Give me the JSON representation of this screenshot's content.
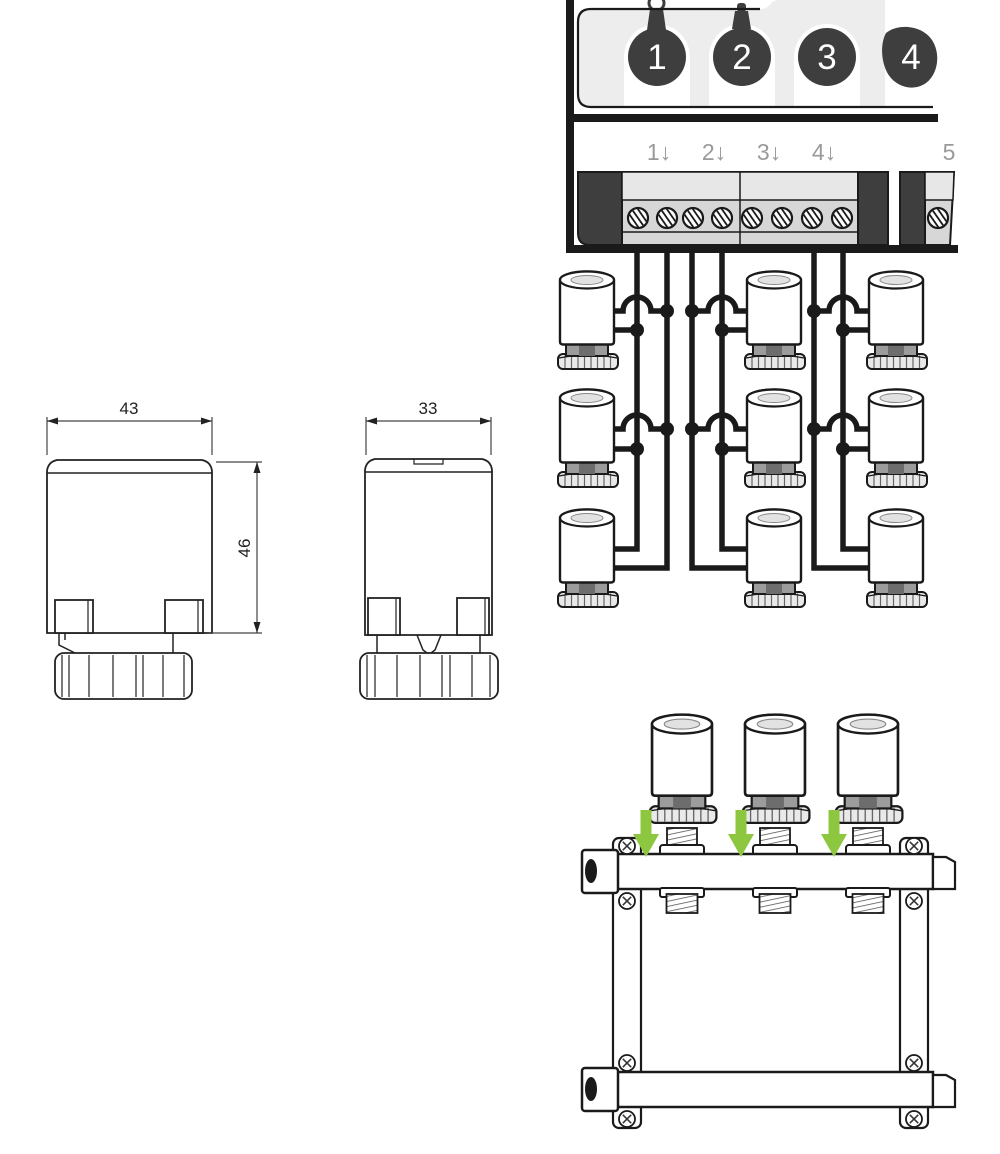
{
  "controller": {
    "channels": [
      "1",
      "2",
      "3",
      "4"
    ],
    "terminal_labels": [
      "1↓",
      "2↓",
      "3↓",
      "4↓",
      "5"
    ]
  },
  "dimension_front": {
    "width": "43",
    "height": "46"
  },
  "dimension_side": {
    "width": "33"
  },
  "colors": {
    "line": "#1a1a1a",
    "dark_block": "#3f3e3e",
    "panel_gray": "#ededed",
    "strip_gray": "#d7d7d7",
    "strip_light": "#e7e7e7",
    "collar_gray": "#9c9c9c",
    "collar_dark": "#6d6d6d",
    "nut_gray": "#e9e9e9",
    "label_gray": "#9a9a9a",
    "green_arrow": "#8dc63f"
  },
  "icons": {
    "terminal_screw": "slotted-screw",
    "bracket_screw": "cross-screw",
    "install_arrow": "down-arrow"
  }
}
